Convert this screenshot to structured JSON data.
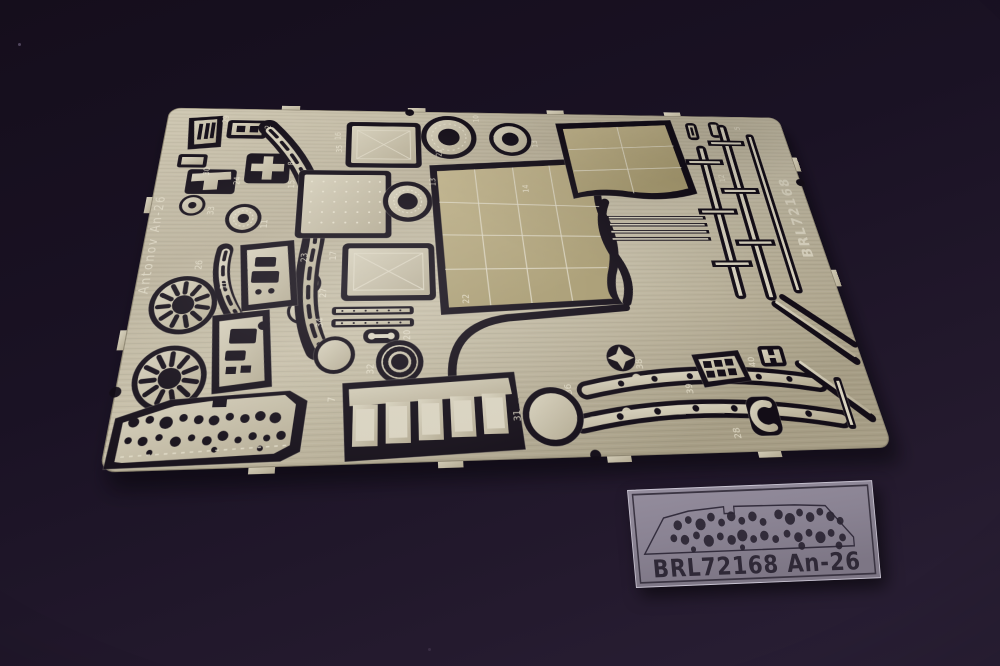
{
  "scene": {
    "subject": "photo-etched brass detail fret with acetate instrument film",
    "background_color": "#1c1322",
    "brass_color": "#bdb49c",
    "cutout_color": "#130d17"
  },
  "fret": {
    "left_edge_text": "Antonov An-26",
    "right_edge_text": "BRL72168",
    "part_numbers": [
      "29",
      "2",
      "30",
      "24",
      "8",
      "33",
      "11",
      "35",
      "10",
      "10",
      "26",
      "23",
      "27",
      "15",
      "16",
      "13",
      "17",
      "13",
      "14",
      "21",
      "12",
      "5",
      "34",
      "32",
      "20",
      "22",
      "7",
      "31",
      "38",
      "39",
      "36",
      "37",
      "40",
      "28"
    ]
  },
  "film": {
    "label": "BRL72168 An-26",
    "film_color": "#8f8898",
    "print_color": "#2f2937"
  }
}
